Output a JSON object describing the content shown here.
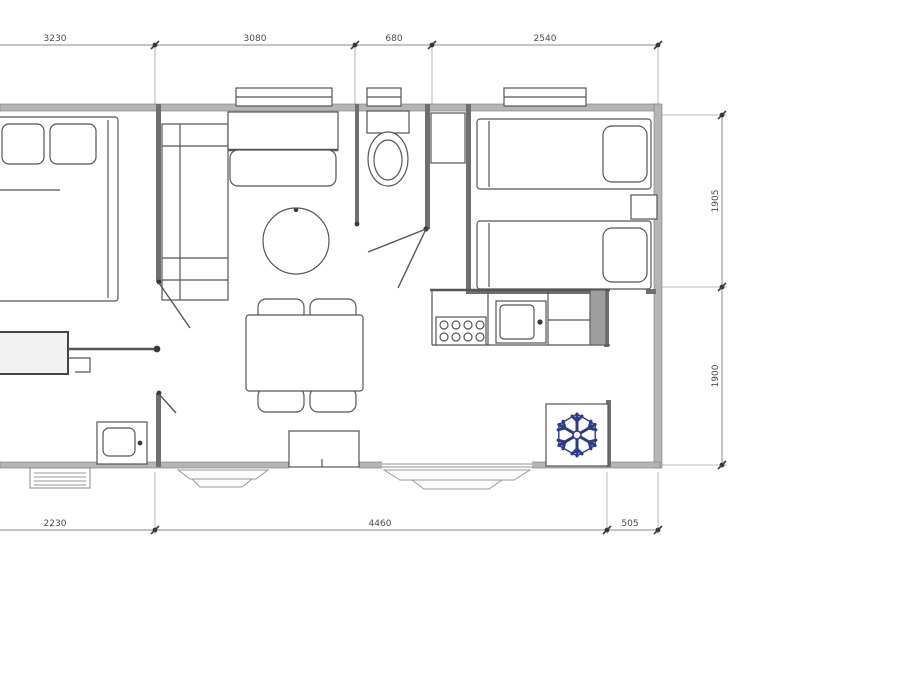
{
  "document": {
    "type": "mobile-home floor plan drawing"
  },
  "dimensions": {
    "top": [
      "3230",
      "3080",
      "680",
      "2540"
    ],
    "right": [
      "1905",
      "1900"
    ],
    "bottom": [
      "2230",
      "4460",
      "505"
    ]
  },
  "colors": {
    "line": "#555555",
    "exterior_wall": "#b5b5b5",
    "interior_wall": "#6f6f6f",
    "dimension": "#8a8a8a",
    "snowflake": "#2b3990",
    "background": "#ffffff"
  },
  "icons": {
    "snowflake": "❄"
  }
}
